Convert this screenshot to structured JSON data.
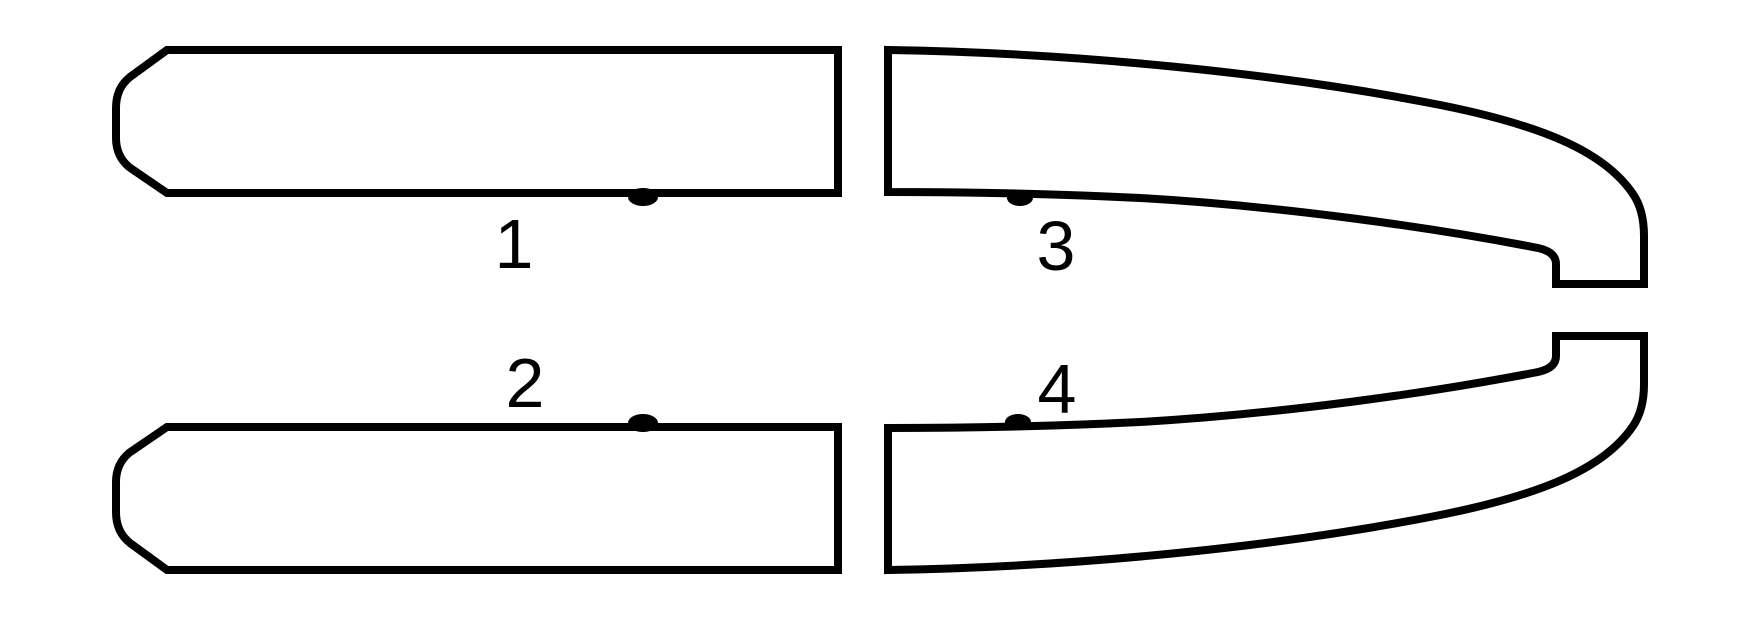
{
  "diagram": {
    "background_color": "#ffffff",
    "line_color": "#000000",
    "parts": [
      {
        "label": "1"
      },
      {
        "label": "2"
      },
      {
        "label": "3"
      },
      {
        "label": "4"
      }
    ]
  }
}
